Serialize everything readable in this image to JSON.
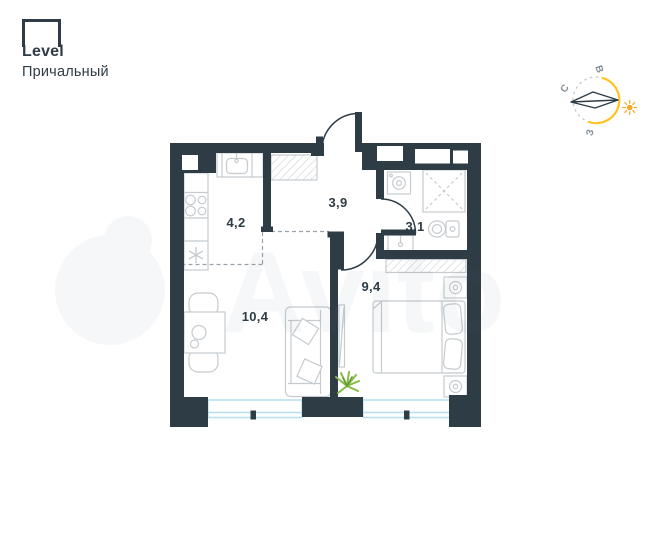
{
  "header": {
    "logo_text": "Level",
    "project_name": "Причальный"
  },
  "compass": {
    "north_label": "С",
    "east_label": "В",
    "west_label": "З"
  },
  "plan": {
    "rooms": [
      {
        "name": "kitchen",
        "area_label": "4,2"
      },
      {
        "name": "hallway",
        "area_label": "3,9"
      },
      {
        "name": "bathroom",
        "area_label": "3,1"
      },
      {
        "name": "bedroom",
        "area_label": "9,4"
      },
      {
        "name": "living-room",
        "area_label": "10,4"
      }
    ]
  },
  "watermark": {
    "text": "Avito"
  },
  "colors": {
    "wall": "#2e3c46",
    "furniture_outline": "#c5cbcf",
    "window_glass": "#b5dff0",
    "zone_dash": "#9aa3ab",
    "compass_yellow": "#ffc422",
    "sun_orange": "#f3a81f",
    "plant_green": "#86bb45",
    "label_text": "#2e3c46",
    "logo_navy": "#2f3b46"
  },
  "icons": [
    "compass-rose",
    "sun-icon",
    "stove-icon",
    "kitchen-sink-icon",
    "fridge-snowflake-icon",
    "washing-machine-icon",
    "shower-icon",
    "toilet-icon",
    "bathroom-sink-icon",
    "bed-icon",
    "lamp-icon",
    "mirror-icon",
    "sofa-icon",
    "dining-table-icon",
    "plant-icon"
  ]
}
